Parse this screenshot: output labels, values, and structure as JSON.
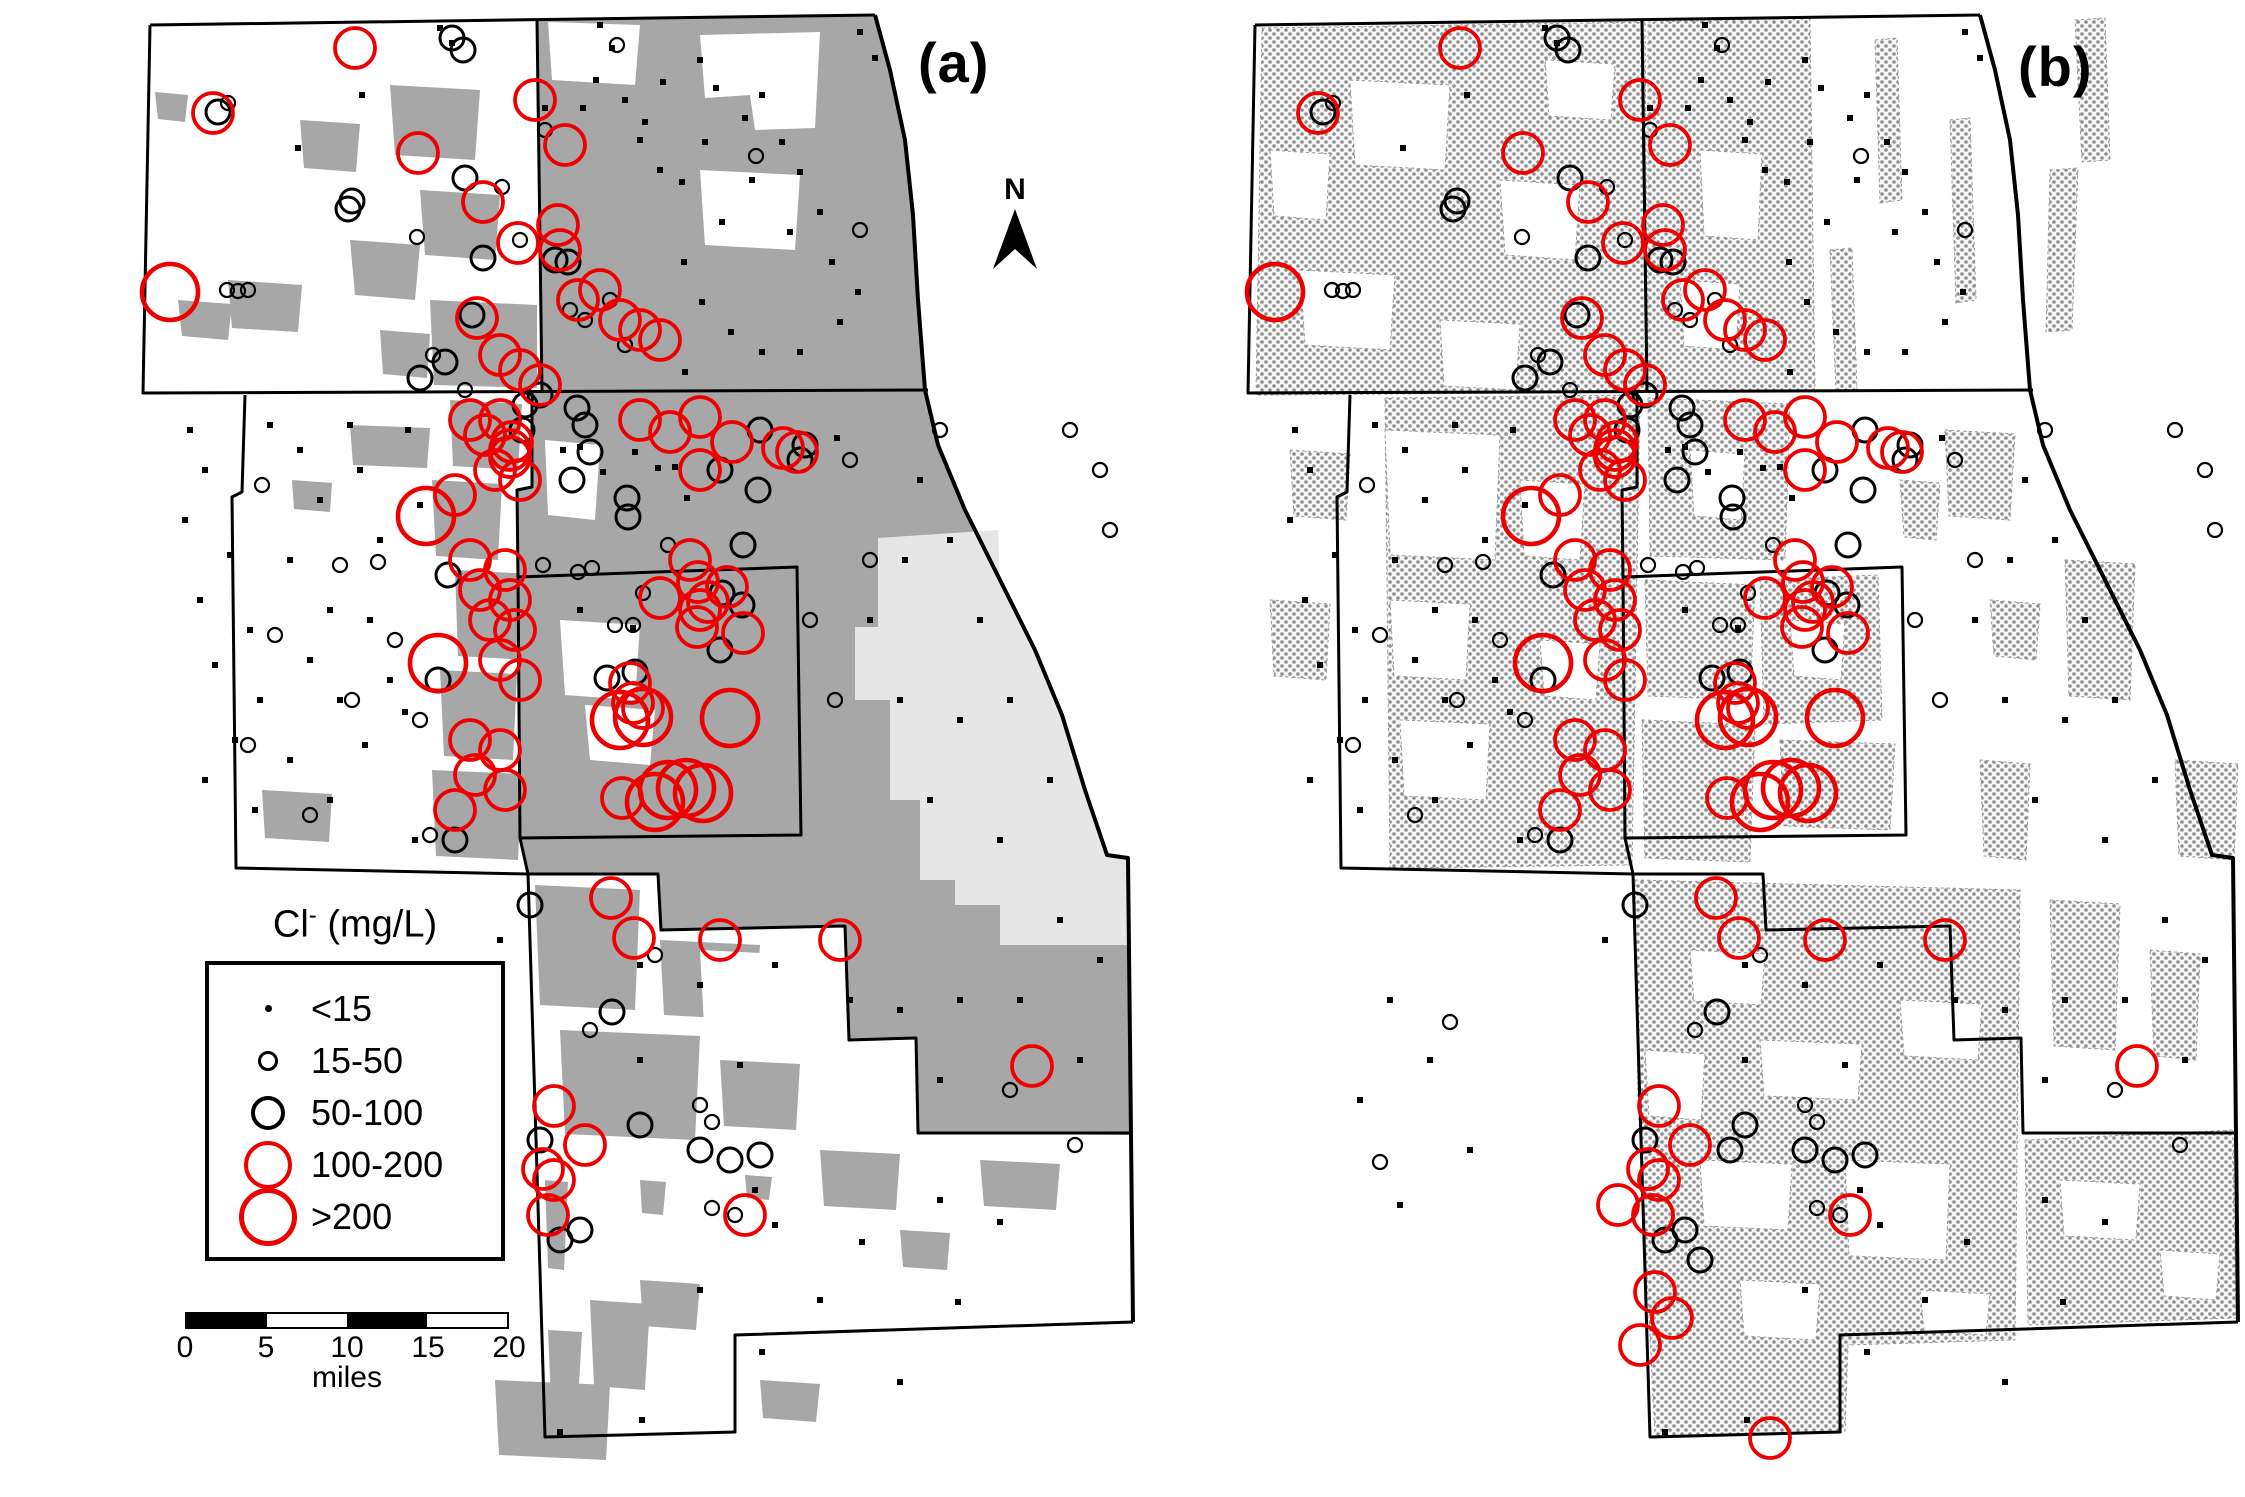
{
  "figure": {
    "panel_a_label": "(a)",
    "panel_b_label": "(b)",
    "north_label": "N"
  },
  "legend": {
    "title_main": "Cl",
    "title_sup": "-",
    "title_unit": " (mg/L)",
    "classes": [
      {
        "label": "<15",
        "color": "#000000",
        "type": "dot",
        "map_radius": 3,
        "swatch_d": 7,
        "stroke_w": 0
      },
      {
        "label": "15-50",
        "color": "#000000",
        "type": "circle",
        "map_radius": 7,
        "swatch_d": 20,
        "stroke_w": 2.2
      },
      {
        "label": "50-100",
        "color": "#000000",
        "type": "circle",
        "map_radius": 12,
        "swatch_d": 34,
        "stroke_w": 3
      },
      {
        "label": "100-200",
        "color": "#ee0000",
        "type": "circle",
        "map_radius": 20,
        "swatch_d": 48,
        "stroke_w": 3.8
      },
      {
        "label": ">200",
        "color": "#ee0000",
        "type": "circle",
        "map_radius": 28,
        "swatch_d": 58,
        "stroke_w": 4.6
      }
    ]
  },
  "scalebar": {
    "ticks": [
      "0",
      "5",
      "10",
      "15",
      "20"
    ],
    "unit": "miles"
  },
  "colors": {
    "urban_gray": "#a7a7a7",
    "city_gray": "#e6e6e6",
    "stipple_dot": "#8e8e8e",
    "red": "#ee0000",
    "black": "#000000",
    "water_white": "#ffffff"
  },
  "map_points": {
    "panel_dx": 1105,
    "a": {
      "c0": [
        [
          440,
          28
        ],
        [
          452,
          43
        ],
        [
          600,
          25
        ],
        [
          612,
          48
        ],
        [
          596,
          80
        ],
        [
          583,
          108
        ],
        [
          625,
          100
        ],
        [
          640,
          140
        ],
        [
          660,
          170
        ],
        [
          700,
          60
        ],
        [
          716,
          88
        ],
        [
          745,
          118
        ],
        [
          762,
          95
        ],
        [
          782,
          142
        ],
        [
          800,
          172
        ],
        [
          752,
          180
        ],
        [
          820,
          212
        ],
        [
          790,
          232
        ],
        [
          832,
          262
        ],
        [
          858,
          292
        ],
        [
          840,
          322
        ],
        [
          705,
          142
        ],
        [
          682,
          182
        ],
        [
          722,
          222
        ],
        [
          684,
          262
        ],
        [
          702,
          302
        ],
        [
          731,
          332
        ],
        [
          762,
          352
        ],
        [
          800,
          352
        ],
        [
          685,
          372
        ],
        [
          645,
          122
        ],
        [
          663,
          82
        ],
        [
          860,
          32
        ],
        [
          875,
          58
        ],
        [
          545,
          108
        ],
        [
          362,
          95
        ],
        [
          298,
          148
        ],
        [
          190,
          430
        ],
        [
          205,
          470
        ],
        [
          185,
          520
        ],
        [
          230,
          555
        ],
        [
          200,
          600
        ],
        [
          250,
          630
        ],
        [
          215,
          665
        ],
        [
          260,
          700
        ],
        [
          235,
          740
        ],
        [
          205,
          780
        ],
        [
          255,
          810
        ],
        [
          300,
          450
        ],
        [
          320,
          500
        ],
        [
          290,
          560
        ],
        [
          330,
          610
        ],
        [
          310,
          660
        ],
        [
          340,
          700
        ],
        [
          290,
          760
        ],
        [
          330,
          800
        ],
        [
          360,
          470
        ],
        [
          380,
          540
        ],
        [
          370,
          620
        ],
        [
          390,
          680
        ],
        [
          365,
          745
        ],
        [
          270,
          425
        ],
        [
          350,
          425
        ],
        [
          408,
          430
        ],
        [
          420,
          505
        ],
        [
          405,
          712
        ],
        [
          415,
          840
        ],
        [
          563,
          450
        ],
        [
          580,
          447
        ],
        [
          603,
          472
        ],
        [
          635,
          452
        ],
        [
          658,
          468
        ],
        [
          675,
          467
        ],
        [
          687,
          498
        ],
        [
          837,
          438
        ],
        [
          920,
          480
        ],
        [
          950,
          540
        ],
        [
          905,
          560
        ],
        [
          980,
          620
        ],
        [
          1010,
          700
        ],
        [
          1050,
          780
        ],
        [
          900,
          700
        ],
        [
          870,
          620
        ],
        [
          960,
          720
        ],
        [
          930,
          800
        ],
        [
          1000,
          840
        ],
        [
          1060,
          920
        ],
        [
          1100,
          960
        ],
        [
          1020,
          1000
        ],
        [
          960,
          1000
        ],
        [
          900,
          1010
        ],
        [
          1080,
          1060
        ],
        [
          940,
          1080
        ],
        [
          580,
          610
        ],
        [
          633,
          628
        ],
        [
          500,
          940
        ],
        [
          640,
          965
        ],
        [
          700,
          985
        ],
        [
          775,
          965
        ],
        [
          850,
          1000
        ],
        [
          640,
          1060
        ],
        [
          700,
          1290
        ],
        [
          762,
          1352
        ],
        [
          820,
          1300
        ],
        [
          900,
          1382
        ],
        [
          642,
          1420
        ],
        [
          560,
          1432
        ],
        [
          862,
          1242
        ],
        [
          958,
          1302
        ],
        [
          1000,
          1222
        ],
        [
          940,
          1200
        ],
        [
          740,
          1065
        ],
        [
          755,
          1190
        ],
        [
          775,
          1225
        ]
      ],
      "c1": [
        [
          617,
          45
        ],
        [
          228,
          103
        ],
        [
          502,
          187
        ],
        [
          417,
          237
        ],
        [
          520,
          240
        ],
        [
          227,
          290
        ],
        [
          238,
          291
        ],
        [
          248,
          290
        ],
        [
          433,
          355
        ],
        [
          465,
          390
        ],
        [
          756,
          156
        ],
        [
          860,
          230
        ],
        [
          570,
          310
        ],
        [
          585,
          320
        ],
        [
          545,
          130
        ],
        [
          610,
          300
        ],
        [
          625,
          345
        ],
        [
          262,
          485
        ],
        [
          340,
          565
        ],
        [
          275,
          635
        ],
        [
          352,
          700
        ],
        [
          248,
          745
        ],
        [
          310,
          815
        ],
        [
          395,
          640
        ],
        [
          420,
          720
        ],
        [
          430,
          835
        ],
        [
          378,
          562
        ],
        [
          543,
          565
        ],
        [
          578,
          572
        ],
        [
          592,
          568
        ],
        [
          643,
          593
        ],
        [
          633,
          625
        ],
        [
          668,
          545
        ],
        [
          850,
          460
        ],
        [
          940,
          430
        ],
        [
          1070,
          430
        ],
        [
          1100,
          470
        ],
        [
          1110,
          530
        ],
        [
          870,
          560
        ],
        [
          615,
          625
        ],
        [
          810,
          620
        ],
        [
          835,
          700
        ],
        [
          655,
          955
        ],
        [
          712,
          1208
        ],
        [
          735,
          1215
        ],
        [
          1075,
          1145
        ],
        [
          590,
          1030
        ],
        [
          700,
          1105
        ],
        [
          712,
          1122
        ],
        [
          1010,
          1090
        ]
      ],
      "c2": [
        [
          452,
          38
        ],
        [
          463,
          50
        ],
        [
          218,
          112
        ],
        [
          352,
          201
        ],
        [
          348,
          209
        ],
        [
          465,
          178
        ],
        [
          472,
          315
        ],
        [
          483,
          258
        ],
        [
          445,
          362
        ],
        [
          420,
          378
        ],
        [
          555,
          260
        ],
        [
          568,
          262
        ],
        [
          540,
          395
        ],
        [
          525,
          405
        ],
        [
          577,
          408
        ],
        [
          585,
          425
        ],
        [
          590,
          452
        ],
        [
          572,
          480
        ],
        [
          627,
          498
        ],
        [
          628,
          517
        ],
        [
          522,
          430
        ],
        [
          758,
          490
        ],
        [
          743,
          545
        ],
        [
          805,
          445
        ],
        [
          607,
          678
        ],
        [
          635,
          672
        ],
        [
          722,
          593
        ],
        [
          742,
          605
        ],
        [
          720,
          650
        ],
        [
          438,
          680
        ],
        [
          455,
          840
        ],
        [
          448,
          575
        ],
        [
          760,
          430
        ],
        [
          800,
          460
        ],
        [
          720,
          470
        ],
        [
          612,
          1012
        ],
        [
          530,
          905
        ],
        [
          640,
          1125
        ],
        [
          540,
          1140
        ],
        [
          700,
          1150
        ],
        [
          730,
          1160
        ],
        [
          760,
          1155
        ],
        [
          560,
          1240
        ],
        [
          580,
          1230
        ]
      ],
      "c3": [
        [
          355,
          48
        ],
        [
          213,
          113
        ],
        [
          418,
          153
        ],
        [
          483,
          202
        ],
        [
          518,
          243
        ],
        [
          477,
          318
        ],
        [
          578,
          300
        ],
        [
          500,
          355
        ],
        [
          520,
          370
        ],
        [
          540,
          385
        ],
        [
          535,
          100
        ],
        [
          565,
          145
        ],
        [
          558,
          225
        ],
        [
          560,
          250
        ],
        [
          600,
          290
        ],
        [
          620,
          320
        ],
        [
          640,
          330
        ],
        [
          660,
          340
        ],
        [
          512,
          442
        ],
        [
          510,
          457
        ],
        [
          783,
          448
        ],
        [
          797,
          452
        ],
        [
          640,
          420
        ],
        [
          670,
          432
        ],
        [
          700,
          417
        ],
        [
          732,
          442
        ],
        [
          700,
          470
        ],
        [
          690,
          560
        ],
        [
          698,
          582
        ],
        [
          727,
          587
        ],
        [
          708,
          602
        ],
        [
          660,
          598
        ],
        [
          700,
          610
        ],
        [
          697,
          627
        ],
        [
          743,
          633
        ],
        [
          622,
          798
        ],
        [
          630,
          683
        ],
        [
          633,
          703
        ],
        [
          643,
          708
        ],
        [
          455,
          495
        ],
        [
          470,
          420
        ],
        [
          485,
          435
        ],
        [
          500,
          420
        ],
        [
          510,
          450
        ],
        [
          495,
          470
        ],
        [
          520,
          480
        ],
        [
          470,
          560
        ],
        [
          505,
          570
        ],
        [
          480,
          590
        ],
        [
          510,
          600
        ],
        [
          490,
          620
        ],
        [
          515,
          630
        ],
        [
          500,
          660
        ],
        [
          520,
          680
        ],
        [
          470,
          740
        ],
        [
          500,
          750
        ],
        [
          475,
          775
        ],
        [
          505,
          790
        ],
        [
          455,
          810
        ],
        [
          611,
          898
        ],
        [
          634,
          938
        ],
        [
          720,
          940
        ],
        [
          554,
          1106
        ],
        [
          585,
          1145
        ],
        [
          543,
          1169
        ],
        [
          554,
          1180
        ],
        [
          840,
          940
        ],
        [
          1032,
          1066
        ],
        [
          745,
          1215
        ],
        [
          548,
          1215
        ]
      ],
      "c4": [
        [
          170,
          292
        ],
        [
          620,
          720
        ],
        [
          643,
          717
        ],
        [
          730,
          718
        ],
        [
          668,
          790
        ],
        [
          686,
          788
        ],
        [
          703,
          793
        ],
        [
          655,
          802
        ],
        [
          426,
          516
        ],
        [
          438,
          663
        ]
      ]
    },
    "b_extra": [
      [
        1618,
        1205,
        3
      ],
      [
        1655,
        1292,
        3
      ],
      [
        1672,
        1318,
        3
      ],
      [
        1700,
        1260,
        2
      ],
      [
        1730,
        1150,
        2
      ],
      [
        1640,
        1345,
        3
      ],
      [
        1770,
        1438,
        3
      ],
      [
        1390,
        1000,
        0
      ],
      [
        1430,
        1060,
        0
      ],
      [
        1360,
        1100,
        0
      ],
      [
        1470,
        1150,
        0
      ],
      [
        1400,
        1205,
        0
      ],
      [
        1450,
        1022,
        1
      ],
      [
        1380,
        1162,
        1
      ]
    ]
  }
}
